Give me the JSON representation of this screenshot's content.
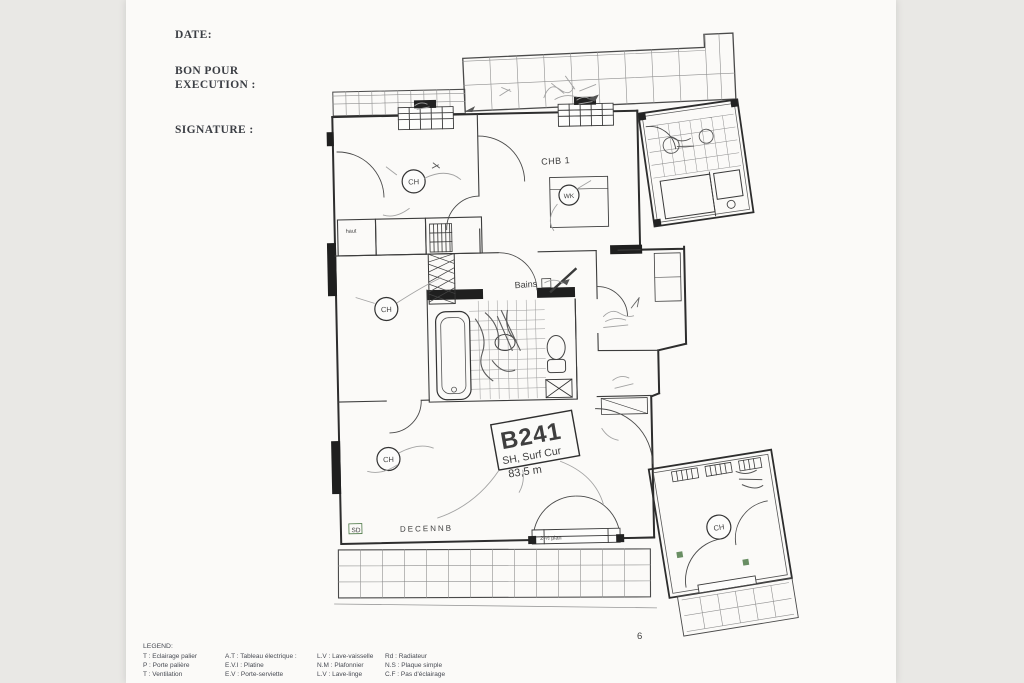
{
  "document": {
    "date_label": "DATE:",
    "approval_line1": "BON POUR",
    "approval_line2": "EXECUTION :",
    "signature_label": "SIGNATURE :",
    "page_number": "6"
  },
  "plan": {
    "unit_id": "B241",
    "surface_label": "SH, Surf Cur",
    "surface_value": "83,5 m",
    "room_bedroom1": "CHB 1",
    "room_bath": "Bains",
    "closet_label": "haut",
    "heater_symbol": "CH",
    "vr_symbol": "WK",
    "sd_symbol": "SD",
    "insurance_note": "DECENNB",
    "lintel_note": "2-½ plan"
  },
  "legend": {
    "title": "LEGEND:",
    "columns": [
      [
        "T : Eclairage palier",
        "P : Porte palière",
        "T : Ventilation"
      ],
      [
        "A.T : Tableau électrique :",
        "E.V.I : Platine",
        "E.V : Porte-serviette"
      ],
      [
        "L.V : Lave-vaisselle",
        "N.M : Plafonnier",
        "L.V : Lave-linge"
      ],
      [
        "Rd : Radiateur",
        "N.S : Plaque simple",
        "C.F : Pas d'éclairage"
      ]
    ]
  },
  "colors": {
    "ink": "#3a3a3a",
    "green": "#4f7a49",
    "pencil": "#a3a3a3"
  }
}
